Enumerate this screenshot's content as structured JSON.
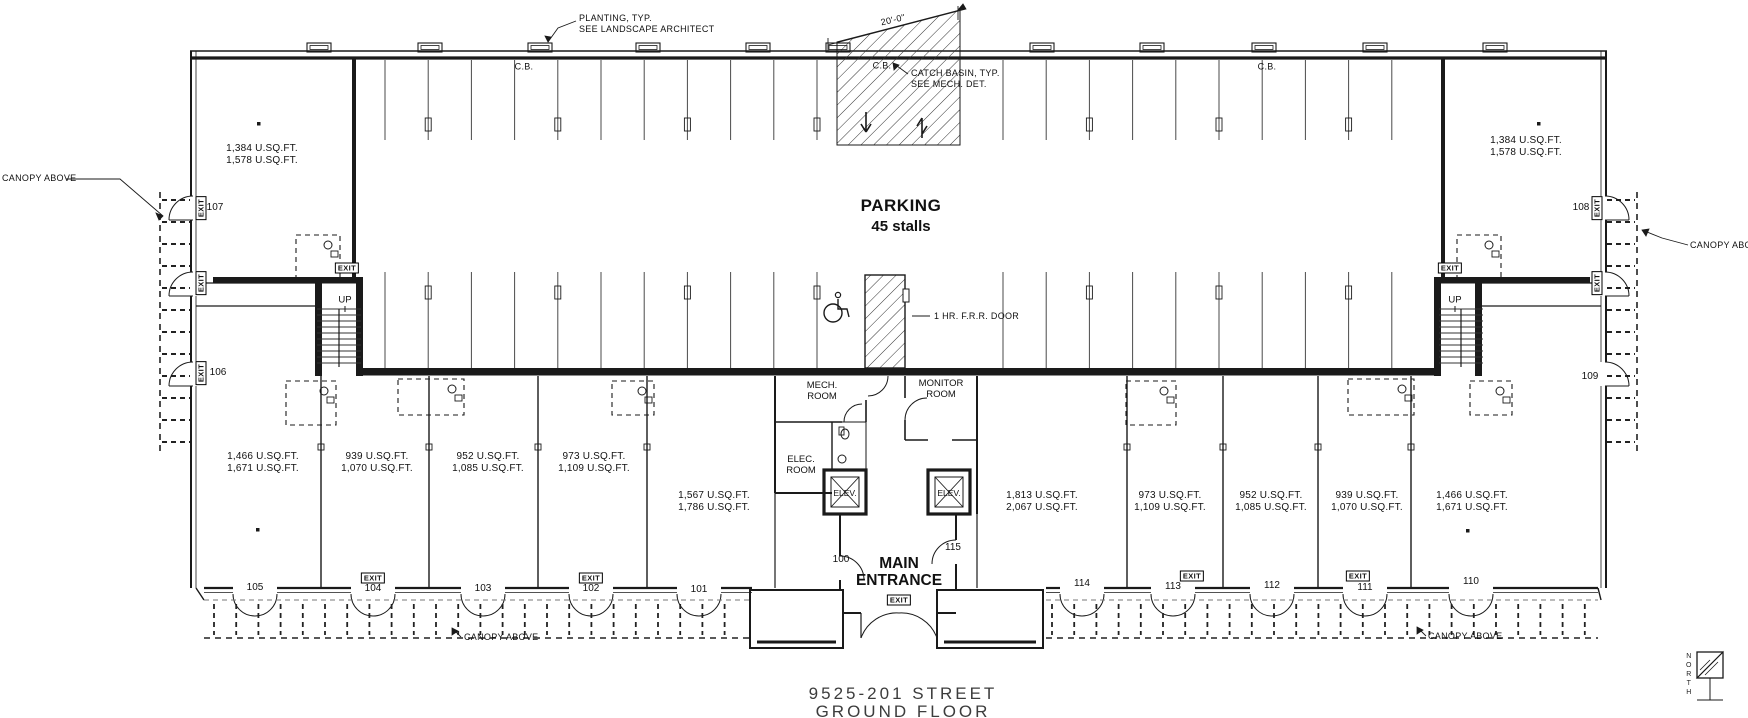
{
  "labels": {
    "exit": "EXIT",
    "up": "UP",
    "cb": "C.B.",
    "elev": "ELEV.",
    "canopy_above": "CANOPY ABOVE",
    "canopy_above_trunc": "CANOPY ABO",
    "north": "NORTH"
  },
  "notes": {
    "planting_line1": "PLANTING, TYP.",
    "planting_line2": "SEE LANDSCAPE ARCHITECT",
    "catch_basin_line1": "CATCH BASIN, TYP.",
    "catch_basin_line2": "SEE MECH. DET.",
    "ramp_dimension": "20'-0\"",
    "frr_door": "1 HR. F.R.R. DOOR"
  },
  "parking": {
    "title": "PARKING",
    "count": "45 stalls"
  },
  "rooms": {
    "mech_line1": "MECH.",
    "mech_line2": "ROOM",
    "monitor_line1": "MONITOR",
    "monitor_line2": "ROOM",
    "elec_line1": "ELEC.",
    "elec_line2": "ROOM"
  },
  "entrance": {
    "line1": "MAIN",
    "line2": "ENTRANCE"
  },
  "units": {
    "u100": {
      "number": "100"
    },
    "u101": {
      "number": "101",
      "sqft_line1": "1,567 U.SQ.FT.",
      "sqft_line2": "1,786 U.SQ.FT."
    },
    "u102": {
      "number": "102",
      "sqft_line1": "973 U.SQ.FT.",
      "sqft_line2": "1,109 U.SQ.FT."
    },
    "u103": {
      "number": "103",
      "sqft_line1": "952 U.SQ.FT.",
      "sqft_line2": "1,085 U.SQ.FT."
    },
    "u104": {
      "number": "104",
      "sqft_line1": "939 U.SQ.FT.",
      "sqft_line2": "1,070 U.SQ.FT."
    },
    "u105": {
      "number": "105",
      "sqft_line1": "1,466 U.SQ.FT.",
      "sqft_line2": "1,671 U.SQ.FT."
    },
    "u106": {
      "number": "106"
    },
    "u107": {
      "number": "107",
      "sqft_line1": "1,384 U.SQ.FT.",
      "sqft_line2": "1,578 U.SQ.FT."
    },
    "u108": {
      "number": "108",
      "sqft_line1": "1,384 U.SQ.FT.",
      "sqft_line2": "1,578 U.SQ.FT."
    },
    "u109": {
      "number": "109"
    },
    "u110": {
      "number": "110",
      "sqft_line1": "1,466 U.SQ.FT.",
      "sqft_line2": "1,671 U.SQ.FT."
    },
    "u111": {
      "number": "111",
      "sqft_line1": "939 U.SQ.FT.",
      "sqft_line2": "1,070 U.SQ.FT."
    },
    "u112": {
      "number": "112",
      "sqft_line1": "952 U.SQ.FT.",
      "sqft_line2": "1,085 U.SQ.FT."
    },
    "u113": {
      "number": "113",
      "sqft_line1": "973 U.SQ.FT.",
      "sqft_line2": "1,109 U.SQ.FT."
    },
    "u114": {
      "number": "114",
      "sqft_line1": "1,813 U.SQ.FT.",
      "sqft_line2": "2,067 U.SQ.FT."
    },
    "u115": {
      "number": "115"
    }
  },
  "titleblock": {
    "line1": "9525-201 STREET",
    "line2": "GROUND FLOOR"
  }
}
